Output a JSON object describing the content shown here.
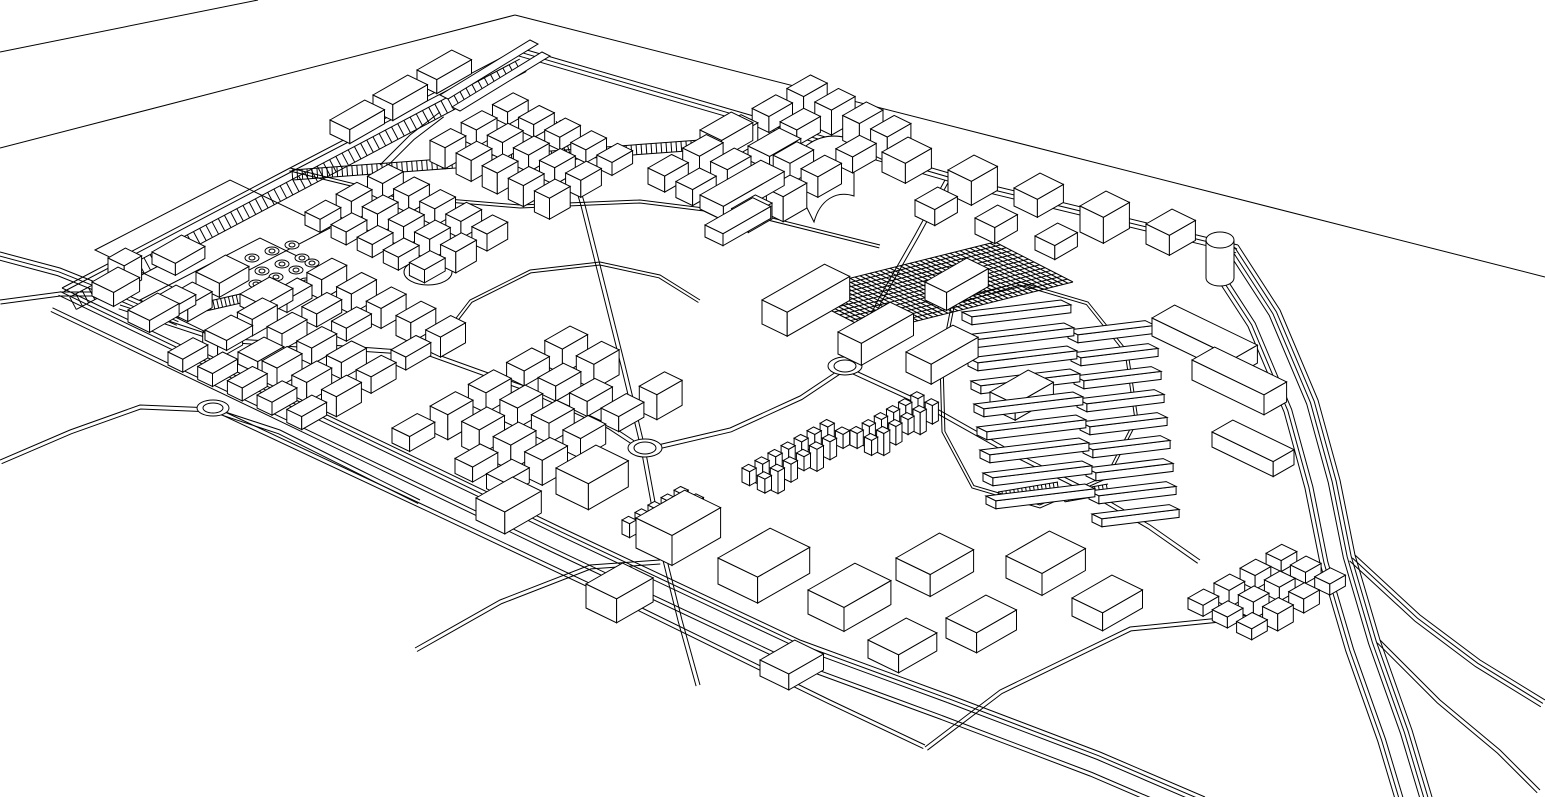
{
  "canvas": {
    "w": 1545,
    "h": 797,
    "background": "#ffffff",
    "stroke": "#000000",
    "stroke_width": 1
  },
  "axes": {
    "u": [
      0.868,
      -0.497
    ],
    "v": [
      0.9,
      0.435
    ]
  },
  "plane_lines": [
    [
      [
        0,
        52
      ],
      [
        258,
        0
      ]
    ],
    [
      [
        0,
        148
      ],
      [
        515,
        15
      ]
    ],
    [
      [
        515,
        15
      ],
      [
        1545,
        277
      ]
    ]
  ],
  "roads": [
    {
      "name": "site-edge-northwest",
      "pts": [
        [
          62,
          288
        ],
        [
          290,
          168
        ],
        [
          520,
          48
        ]
      ],
      "offsets": [
        0,
        4
      ]
    },
    {
      "name": "site-edge-northeast",
      "pts": [
        [
          520,
          48
        ],
        [
          750,
          115
        ],
        [
          990,
          185
        ],
        [
          1238,
          245
        ]
      ],
      "offsets": [
        0,
        4,
        8
      ]
    },
    {
      "name": "site-edge-southwest",
      "pts": [
        [
          62,
          288
        ],
        [
          300,
          402
        ],
        [
          560,
          527
        ],
        [
          800,
          640
        ],
        [
          950,
          695
        ]
      ],
      "offsets": [
        0,
        4,
        8,
        22,
        26
      ]
    },
    {
      "name": "south-road-extension",
      "pts": [
        [
          950,
          695
        ],
        [
          1100,
          752
        ],
        [
          1205,
          797
        ]
      ],
      "offsets": [
        0,
        4,
        8,
        22,
        26
      ]
    },
    {
      "name": "southeast-cross-road",
      "pts": [
        [
          925,
          747
        ],
        [
          1000,
          690
        ],
        [
          1130,
          627
        ],
        [
          1280,
          612
        ]
      ],
      "offsets": [
        0,
        4
      ]
    },
    {
      "name": "highway-main",
      "pts": [
        [
          1238,
          245
        ],
        [
          1280,
          310
        ],
        [
          1318,
          400
        ],
        [
          1340,
          480
        ],
        [
          1355,
          555
        ],
        [
          1380,
          640
        ],
        [
          1412,
          730
        ],
        [
          1432,
          797
        ]
      ],
      "offsets": [
        0,
        4,
        8,
        12,
        28,
        32,
        36
      ]
    },
    {
      "name": "highway-branch-east",
      "pts": [
        [
          1355,
          555
        ],
        [
          1420,
          615
        ],
        [
          1480,
          660
        ],
        [
          1545,
          700
        ]
      ],
      "offsets": [
        0,
        4,
        8
      ]
    },
    {
      "name": "highway-branch-corner",
      "pts": [
        [
          1380,
          640
        ],
        [
          1440,
          700
        ],
        [
          1500,
          750
        ],
        [
          1540,
          790
        ]
      ],
      "offsets": [
        0,
        4
      ]
    },
    {
      "name": "west-entry-upper",
      "pts": [
        [
          0,
          252
        ],
        [
          60,
          268
        ],
        [
          120,
          292
        ],
        [
          180,
          318
        ]
      ],
      "offsets": [
        0,
        4,
        8
      ]
    },
    {
      "name": "west-entry-lower",
      "pts": [
        [
          0,
          300
        ],
        [
          60,
          292
        ],
        [
          120,
          292
        ]
      ],
      "offsets": [
        0,
        4
      ]
    },
    {
      "name": "west-spur",
      "pts": [
        [
          0,
          460
        ],
        [
          70,
          430
        ],
        [
          140,
          405
        ],
        [
          213,
          408
        ]
      ],
      "offsets": [
        0,
        4
      ]
    },
    {
      "name": "spur-to-perimeter",
      "pts": [
        [
          213,
          408
        ],
        [
          280,
          430
        ],
        [
          360,
          470
        ],
        [
          420,
          500
        ]
      ],
      "offsets": [
        0,
        4
      ]
    },
    {
      "name": "southwest-onramp",
      "pts": [
        [
          415,
          648
        ],
        [
          500,
          600
        ],
        [
          590,
          565
        ],
        [
          660,
          560
        ]
      ],
      "offsets": [
        0,
        4
      ]
    },
    {
      "name": "inner-service-road",
      "pts": [
        [
          225,
          412
        ],
        [
          430,
          508
        ],
        [
          640,
          607
        ],
        [
          830,
          700
        ],
        [
          925,
          745
        ]
      ],
      "offsets": [
        0,
        4
      ]
    },
    {
      "name": "central-spine-west",
      "pts": [
        [
          120,
          305
        ],
        [
          220,
          338
        ],
        [
          330,
          345
        ],
        [
          430,
          352
        ],
        [
          530,
          388
        ],
        [
          610,
          425
        ],
        [
          645,
          448
        ]
      ],
      "offsets": [
        0,
        4
      ]
    },
    {
      "name": "central-spine-mid",
      "pts": [
        [
          645,
          448
        ],
        [
          730,
          428
        ],
        [
          800,
          396
        ],
        [
          845,
          366
        ]
      ],
      "offsets": [
        0,
        4
      ]
    },
    {
      "name": "central-spine-east",
      "pts": [
        [
          845,
          366
        ],
        [
          930,
          405
        ],
        [
          1010,
          450
        ],
        [
          1090,
          490
        ],
        [
          1150,
          525
        ],
        [
          1200,
          560
        ]
      ],
      "offsets": [
        0,
        4
      ]
    },
    {
      "name": "north-connector",
      "pts": [
        [
          845,
          366
        ],
        [
          878,
          300
        ],
        [
          915,
          235
        ],
        [
          945,
          180
        ]
      ],
      "offsets": [
        0,
        4
      ]
    },
    {
      "name": "west-vertical-road",
      "pts": [
        [
          560,
          120
        ],
        [
          585,
          205
        ],
        [
          605,
          285
        ],
        [
          625,
          365
        ],
        [
          645,
          448
        ],
        [
          662,
          540
        ],
        [
          682,
          620
        ],
        [
          700,
          685
        ]
      ],
      "offsets": [
        0,
        4
      ]
    },
    {
      "name": "terrace-loop",
      "pts": [
        [
          952,
          302
        ],
        [
          1020,
          282
        ],
        [
          1088,
          302
        ],
        [
          1128,
          352
        ],
        [
          1138,
          420
        ],
        [
          1108,
          478
        ],
        [
          1040,
          508
        ],
        [
          972,
          488
        ],
        [
          942,
          432
        ],
        [
          940,
          362
        ],
        [
          952,
          302
        ]
      ],
      "offsets": [
        0,
        3
      ]
    },
    {
      "name": "mid-curvy-loop",
      "pts": [
        [
          430,
          352
        ],
        [
          470,
          300
        ],
        [
          530,
          270
        ],
        [
          600,
          262
        ],
        [
          660,
          275
        ],
        [
          700,
          300
        ]
      ],
      "offsets": [
        0,
        3
      ]
    },
    {
      "name": "upper-inner-road",
      "pts": [
        [
          290,
          168
        ],
        [
          400,
          195
        ],
        [
          520,
          205
        ],
        [
          640,
          200
        ],
        [
          760,
          215
        ],
        [
          880,
          245
        ]
      ],
      "offsets": [
        0,
        3
      ]
    },
    {
      "name": "north-ramp-approach",
      "pts": [
        [
          380,
          165
        ],
        [
          410,
          135
        ],
        [
          440,
          112
        ]
      ],
      "offsets": [
        0,
        6
      ]
    }
  ],
  "bands": [
    {
      "name": "railway-hatch-northwest",
      "a": [
        66,
        290
      ],
      "b": [
        516,
        52
      ],
      "o1": 8,
      "o2": 22,
      "step": 7
    },
    {
      "name": "hatch-band-upper",
      "a": [
        292,
        170
      ],
      "b": [
        700,
        140
      ],
      "o1": 0,
      "o2": 10,
      "step": 5
    },
    {
      "name": "parking-strip-west",
      "a": [
        205,
        302
      ],
      "b": [
        258,
        290
      ],
      "o1": 0,
      "o2": 9,
      "step": 4
    },
    {
      "name": "parking-strip-south-terrace-1",
      "a": [
        998,
        492
      ],
      "b": [
        1058,
        482
      ],
      "o1": 0,
      "o2": 10,
      "step": 4
    },
    {
      "name": "parking-strip-south-terrace-2",
      "a": [
        1063,
        492
      ],
      "b": [
        1108,
        484
      ],
      "o1": 0,
      "o2": 10,
      "step": 4
    }
  ],
  "plaza": {
    "name": "gridded-plaza",
    "o": [
      795,
      292
    ],
    "a": [
      200,
      -50
    ],
    "b": [
      78,
      40
    ],
    "na": 40,
    "nb": 14
  },
  "roundabouts": [
    {
      "c": [
        213,
        408
      ],
      "rx": 16,
      "ry": 8
    },
    {
      "c": [
        645,
        448
      ],
      "rx": 17,
      "ry": 9
    },
    {
      "c": [
        845,
        366
      ],
      "rx": 17,
      "ry": 9
    }
  ],
  "ovals": [
    {
      "c": [
        428,
        272
      ],
      "rx": 24,
      "ry": 13
    },
    {
      "c": [
        410,
        356
      ],
      "rx": 11,
      "ry": 6
    }
  ],
  "tree_dots": [
    [
      252,
      258
    ],
    [
      272,
      251
    ],
    [
      292,
      245
    ],
    [
      262,
      271
    ],
    [
      282,
      264
    ],
    [
      302,
      258
    ],
    [
      256,
      284
    ],
    [
      276,
      277
    ],
    [
      296,
      270
    ],
    [
      312,
      263
    ],
    [
      286,
      289
    ],
    [
      306,
      282
    ]
  ],
  "polygons": [
    {
      "name": "north-ramp-1",
      "pts": [
        [
          440,
          95
        ],
        [
          530,
          40
        ],
        [
          538,
          44
        ],
        [
          448,
          99
        ]
      ]
    },
    {
      "name": "north-ramp-2",
      "pts": [
        [
          452,
          107
        ],
        [
          542,
          52
        ],
        [
          550,
          56
        ],
        [
          460,
          111
        ]
      ]
    },
    {
      "name": "parcel-outline-1",
      "pts": [
        [
          95,
          250
        ],
        [
          230,
          180
        ],
        [
          330,
          228
        ],
        [
          195,
          298
        ]
      ],
      "fill": "none"
    },
    {
      "name": "parcel-outline-2",
      "pts": [
        [
          140,
          300
        ],
        [
          260,
          238
        ],
        [
          330,
          272
        ],
        [
          210,
          334
        ]
      ],
      "fill": "none"
    }
  ],
  "special_paths": [
    {
      "name": "sail-landmark-outer",
      "d": "M782,186 C792,148 818,130 848,138 L848,176 C822,170 802,184 794,214 Z"
    },
    {
      "name": "sail-landmark-inner",
      "d": "M802,198 C814,168 832,156 854,160 L854,196 C836,190 820,200 814,222 Z"
    },
    {
      "name": "pill-tower-body",
      "d": "M1206,240 L1206,278 A14 8 0 0 0 1234,278 L1234,240"
    },
    {
      "name": "pill-tower-top",
      "d": "M1206,240 A14 8 0 1 1 1234,240 A14 8 0 1 1 1206,240 Z"
    }
  ],
  "clusters": [
    {
      "name": "district-northwest-dense",
      "o": [
        305,
        212
      ],
      "cols": 7,
      "rows": 5,
      "cw": 36,
      "cd": 29,
      "bw": 0.66,
      "bd": 0.58,
      "h": 13,
      "hv": 8,
      "skip": [
        3,
        10,
        17,
        24,
        31
      ]
    },
    {
      "name": "district-north-center",
      "o": [
        648,
        168
      ],
      "cols": 5,
      "rows": 4,
      "cw": 40,
      "cd": 31,
      "bw": 0.68,
      "bd": 0.6,
      "h": 16,
      "hv": 9,
      "skip": [
        7,
        13
      ]
    },
    {
      "name": "district-center-west",
      "o": [
        168,
        352
      ],
      "cols": 5,
      "rows": 5,
      "cw": 40,
      "cd": 33,
      "bw": 0.72,
      "bd": 0.5,
      "h": 13,
      "hv": 7,
      "skip": [
        6,
        18
      ]
    },
    {
      "name": "district-center",
      "o": [
        392,
        428
      ],
      "cols": 5,
      "rows": 4,
      "cw": 44,
      "cd": 35,
      "bw": 0.66,
      "bd": 0.56,
      "h": 15,
      "hv": 10,
      "skip": [
        5,
        14
      ]
    },
    {
      "name": "micro-towers-a",
      "o": [
        742,
        468
      ],
      "cols": 7,
      "rows": 2,
      "cw": 15,
      "cd": 17,
      "bw": 0.5,
      "bd": 0.5,
      "h": 14,
      "hv": 8,
      "skip": []
    },
    {
      "name": "micro-towers-b",
      "o": [
        622,
        520
      ],
      "cols": 5,
      "rows": 2,
      "cw": 15,
      "cd": 17,
      "bw": 0.5,
      "bd": 0.5,
      "h": 14,
      "hv": 8,
      "skip": []
    },
    {
      "name": "micro-towers-c",
      "o": [
        850,
        430
      ],
      "cols": 6,
      "rows": 2,
      "cw": 14,
      "cd": 16,
      "bw": 0.5,
      "bd": 0.5,
      "h": 15,
      "hv": 7,
      "skip": []
    },
    {
      "name": "houses-southeast-corner",
      "o": [
        1188,
        598
      ],
      "cols": 4,
      "rows": 3,
      "cw": 30,
      "cd": 27,
      "bw": 0.6,
      "bd": 0.62,
      "h": 11,
      "hv": 6,
      "skip": []
    }
  ],
  "strips": [
    {
      "name": "terrace-rows-west",
      "o": [
        962,
        312
      ],
      "rows": 9,
      "step": [
        3,
        23
      ],
      "len": 100,
      "h": 8,
      "dir": [
        0.99,
        -0.12
      ]
    },
    {
      "name": "terrace-rows-east",
      "o": [
        1068,
        330
      ],
      "rows": 9,
      "step": [
        3,
        23
      ],
      "len": 78,
      "h": 8,
      "dir": [
        0.99,
        -0.12
      ]
    }
  ],
  "buildings": [
    [
      882,
      152,
      30,
      26,
      20
    ],
    [
      948,
      170,
      30,
      26,
      24
    ],
    [
      1014,
      188,
      30,
      26,
      18
    ],
    [
      1080,
      206,
      30,
      26,
      26
    ],
    [
      1146,
      224,
      30,
      26,
      20
    ],
    [
      915,
      200,
      26,
      22,
      16
    ],
    [
      975,
      218,
      26,
      22,
      16
    ],
    [
      1035,
      236,
      26,
      22,
      14
    ],
    [
      700,
      195,
      70,
      26,
      14
    ],
    [
      705,
      225,
      55,
      20,
      12
    ],
    [
      762,
      300,
      72,
      28,
      24
    ],
    [
      838,
      332,
      60,
      26,
      22
    ],
    [
      906,
      352,
      54,
      28,
      20
    ],
    [
      925,
      282,
      48,
      24,
      18
    ],
    [
      990,
      392,
      44,
      28,
      16
    ],
    [
      1152,
      318,
      26,
      92,
      18
    ],
    [
      1192,
      360,
      26,
      80,
      20
    ],
    [
      1212,
      432,
      24,
      68,
      15
    ],
    [
      636,
      518,
      56,
      40,
      30
    ],
    [
      718,
      558,
      60,
      44,
      26
    ],
    [
      808,
      590,
      54,
      40,
      24
    ],
    [
      896,
      558,
      50,
      38,
      22
    ],
    [
      946,
      618,
      46,
      34,
      20
    ],
    [
      556,
      468,
      46,
      36,
      26
    ],
    [
      476,
      498,
      42,
      32,
      22
    ],
    [
      586,
      584,
      42,
      34,
      24
    ],
    [
      1006,
      556,
      50,
      40,
      22
    ],
    [
      1072,
      598,
      46,
      34,
      18
    ],
    [
      868,
      640,
      44,
      34,
      18
    ],
    [
      760,
      660,
      40,
      32,
      16
    ],
    [
      92,
      282,
      30,
      24,
      14
    ],
    [
      128,
      310,
      34,
      24,
      12
    ],
    [
      168,
      296,
      28,
      22,
      16
    ],
    [
      205,
      330,
      30,
      24,
      10
    ],
    [
      108,
      258,
      20,
      18,
      24
    ],
    [
      238,
      352,
      30,
      22,
      12
    ],
    [
      152,
      252,
      34,
      26,
      12
    ],
    [
      196,
      272,
      34,
      26,
      14
    ],
    [
      240,
      294,
      34,
      26,
      12
    ],
    [
      150,
      300,
      30,
      22,
      10
    ],
    [
      330,
      120,
      40,
      22,
      14
    ],
    [
      373,
      95,
      40,
      22,
      16
    ],
    [
      417,
      70,
      40,
      22,
      14
    ],
    [
      700,
      130,
      36,
      24,
      18
    ],
    [
      748,
      146,
      36,
      24,
      14
    ]
  ]
}
